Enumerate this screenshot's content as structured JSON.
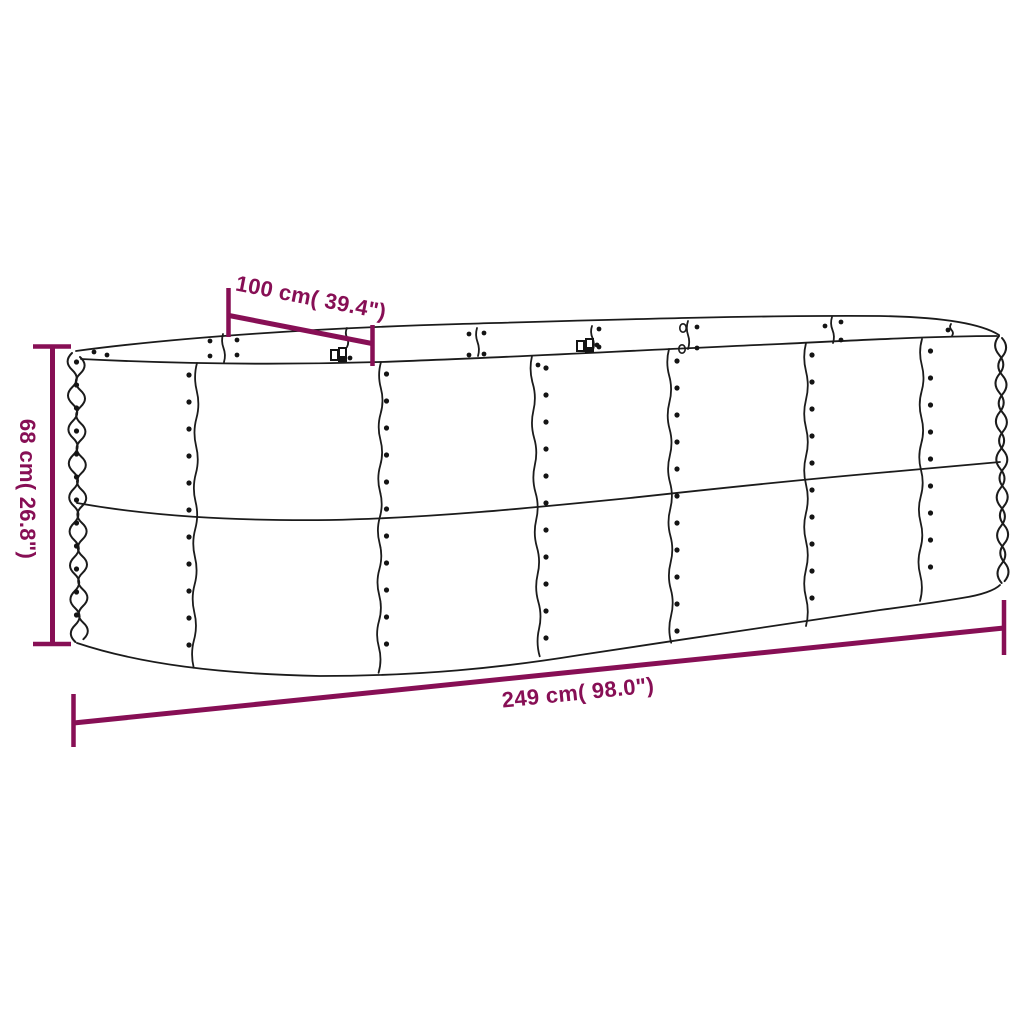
{
  "diagram": {
    "drawing": "raised-garden-bed-oval-planter-outline",
    "colors": {
      "dimension_accent": "#870F55",
      "drawing_line": "#1b1b1b",
      "background": "#ffffff"
    },
    "labels": {
      "width": "100 cm( 39.4\")",
      "height": "68 cm( 26.8\")",
      "length": "249 cm( 98.0\")"
    },
    "values": {
      "width_cm": 100,
      "width_in": 39.4,
      "height_cm": 68,
      "height_in": 26.8,
      "length_cm": 249,
      "length_in": 98.0
    }
  }
}
